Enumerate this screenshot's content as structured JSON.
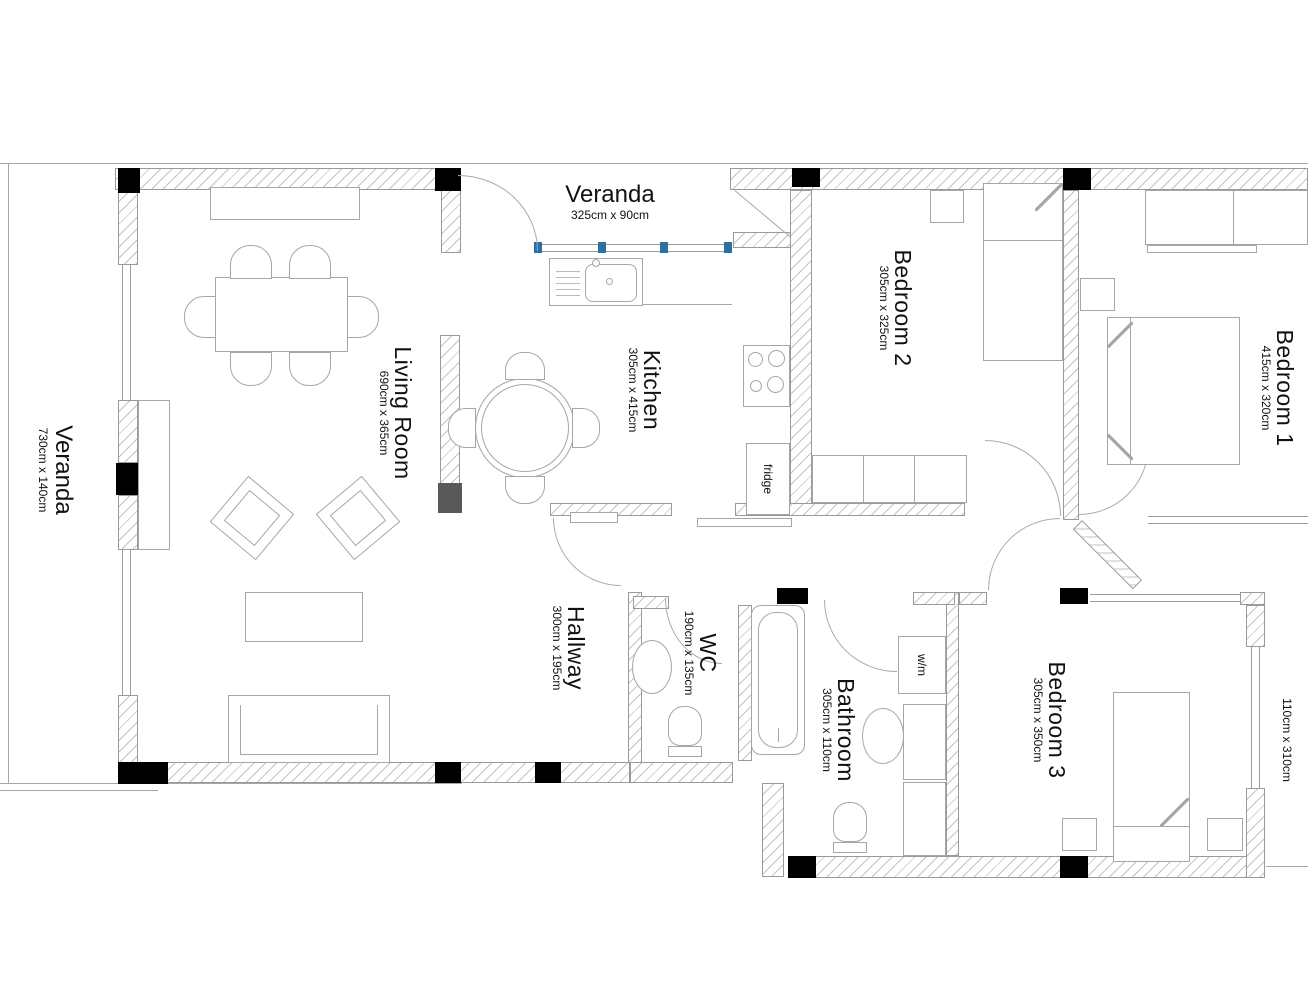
{
  "plan_title": "Apartment floor plan",
  "rooms": {
    "veranda_top": {
      "name": "Veranda",
      "dims": "325cm x 90cm"
    },
    "veranda_left": {
      "name": "Veranda",
      "dims": "730cm x 140cm"
    },
    "living_room": {
      "name": "Living Room",
      "dims": "690cm x 365cm"
    },
    "kitchen": {
      "name": "Kitchen",
      "dims": "305cm x 415cm"
    },
    "bedroom2": {
      "name": "Bedroom 2",
      "dims": "305cm x 325cm"
    },
    "bedroom1": {
      "name": "Bedroom 1",
      "dims": "415cm x 320cm"
    },
    "hallway": {
      "name": "Hallway",
      "dims": "300cm x 195cm"
    },
    "wc": {
      "name": "WC",
      "dims": "190cm x 135cm"
    },
    "bathroom": {
      "name": "Bathroom",
      "dims": "305cm x 110cm"
    },
    "bedroom3": {
      "name": "Bedroom 3",
      "dims": "305cm x 350cm"
    },
    "side_area": {
      "name": "",
      "dims": "110cm x 310cm"
    }
  },
  "appliances": {
    "fridge": {
      "label": "fridge"
    },
    "washing_machine": {
      "label": "w/m"
    }
  },
  "colors": {
    "wall_hatch": "#c3c3c3",
    "column": "#000000",
    "inner_column": "#595959",
    "window_marker": "#2e6f9e",
    "line": "#a6a6a6",
    "text": "#111111"
  }
}
